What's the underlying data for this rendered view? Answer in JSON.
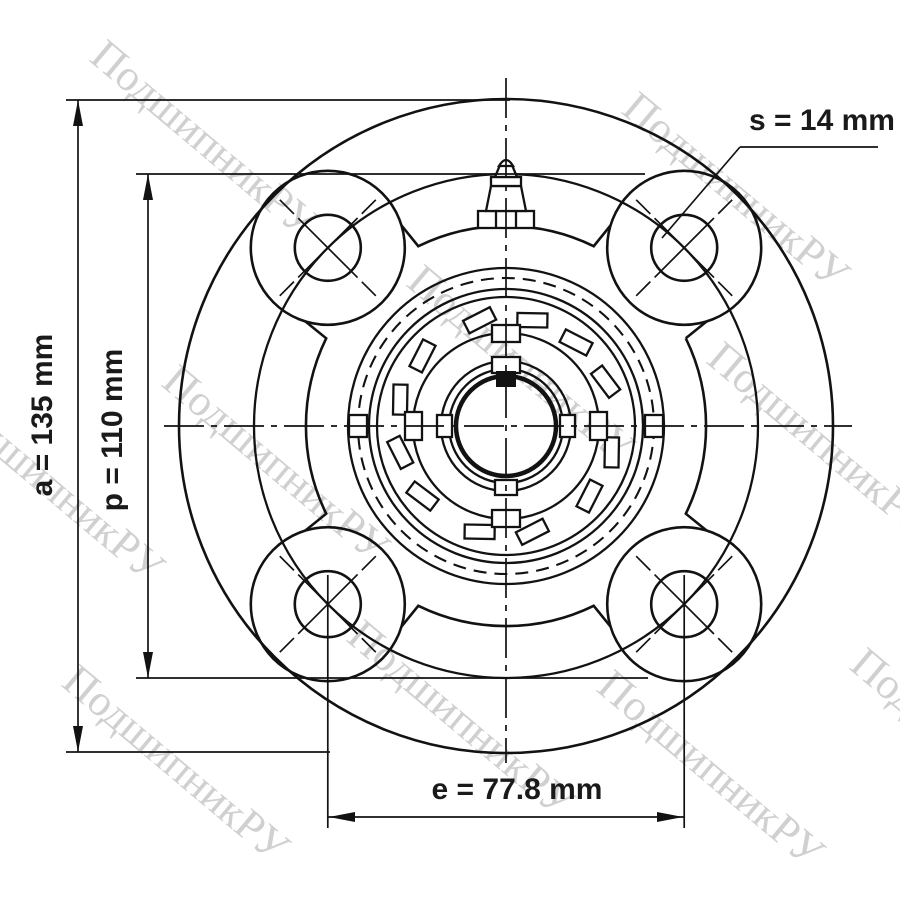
{
  "drawing": {
    "dimension_a": {
      "label": "a = 135 mm"
    },
    "dimension_p": {
      "label": "p = 110 mm"
    },
    "dimension_e": {
      "label": "e = 77.8 mm"
    },
    "dimension_s": {
      "label": "s = 14 mm"
    }
  },
  "watermark": {
    "text": "ПодшипникРУ",
    "color": "#c8c8c8"
  },
  "colors": {
    "line": "#121212",
    "label_text": "#1a1a1a",
    "background": "#ffffff"
  }
}
